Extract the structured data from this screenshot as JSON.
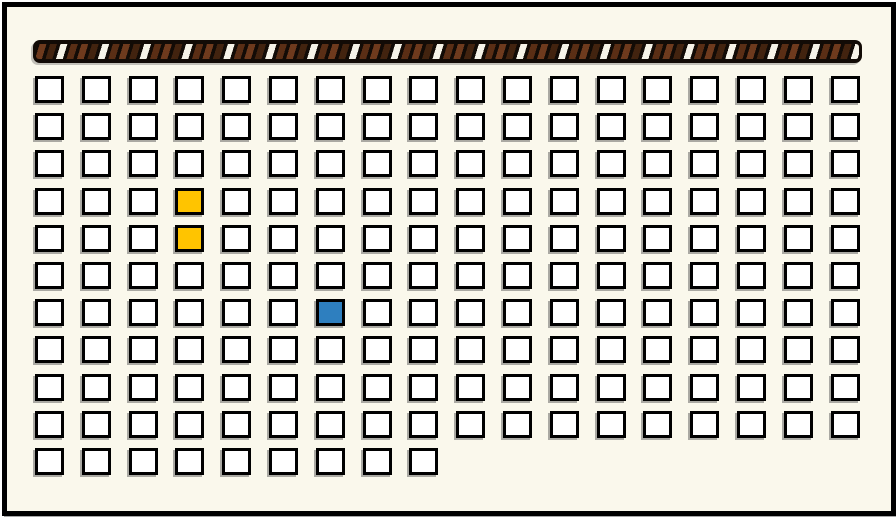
{
  "window": {
    "width_px": 896,
    "height_px": 517,
    "outer_background": "#ffffff"
  },
  "board": {
    "background": "#faf8ec",
    "frame_color": "#000000",
    "frame_thickness_px": 5,
    "hatched_bar": {
      "background": "#120b06",
      "stripe_slant": "forward-diagonal",
      "stripe_colors": {
        "brown_medium": "#6e3a1d",
        "brown_dark": "#42230f",
        "brown_deep": "#5a2e15",
        "white": "#f6f3e8"
      }
    },
    "grid": {
      "columns": 18,
      "rows": 11,
      "row_cell_counts": [
        18,
        18,
        18,
        18,
        18,
        18,
        18,
        18,
        18,
        18,
        9
      ],
      "cell_fill": "#ffffff",
      "cell_border": "#000000",
      "highlighted_cells": [
        {
          "row": 4,
          "col": 4,
          "color": "#ffc400",
          "label": "yellow-cell"
        },
        {
          "row": 5,
          "col": 4,
          "color": "#ffc400",
          "label": "yellow-cell"
        },
        {
          "row": 7,
          "col": 7,
          "color": "#2e7fbf",
          "label": "blue-cell"
        }
      ]
    },
    "layout": {
      "bar_left": 26,
      "bar_top": 33,
      "bar_width": 829,
      "bar_height": 23,
      "cell_origin_x": 28,
      "cell_origin_y": 69,
      "cell_pitch_x": 46.8,
      "cell_pitch_y": 37.2,
      "cell_width": 29,
      "cell_height": 27
    }
  }
}
